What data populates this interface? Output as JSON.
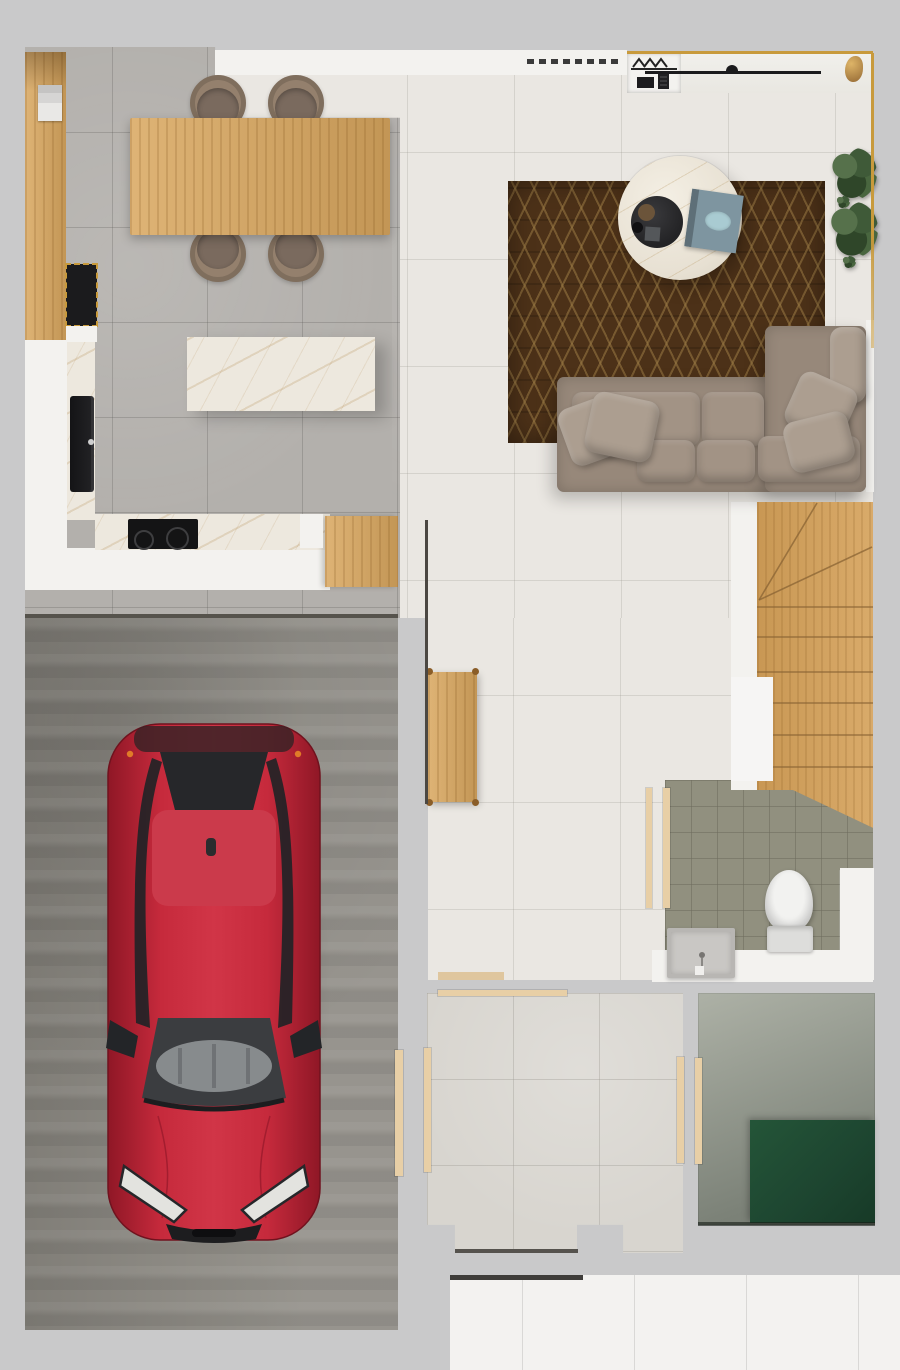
{
  "scene": {
    "type": "architectural-floor-plan-render",
    "view": "top-down",
    "rooms": [
      {
        "name": "kitchen-dining",
        "objects": [
          "wall-cabinet-column",
          "coffee-machine",
          "black-counter",
          "black-sink",
          "marble-counter",
          "cooktop",
          "kitchen-island",
          "dining-table",
          "dining-chairs-x4"
        ]
      },
      {
        "name": "living-room",
        "objects": [
          "geometric-rug",
          "round-marble-coffee-table",
          "decor-tray",
          "book",
          "corner-sofa",
          "throw-pillows",
          "potted-plants-x2",
          "wall-rail",
          "coat-hangers",
          "gold-trim"
        ]
      },
      {
        "name": "staircase",
        "objects": [
          "winder-stairs"
        ]
      },
      {
        "name": "hallway",
        "objects": [
          "wooden-bench",
          "wood-threshold"
        ]
      },
      {
        "name": "bathroom",
        "objects": [
          "toilet",
          "vanity-sink",
          "door"
        ]
      },
      {
        "name": "garage",
        "objects": [
          "red-car",
          "concrete-floor",
          "side-door"
        ]
      },
      {
        "name": "storage-room",
        "objects": [
          "doors-x3"
        ]
      },
      {
        "name": "utility-room",
        "objects": [
          "green-mat",
          "door"
        ]
      },
      {
        "name": "porch",
        "objects": [
          "tile-floor"
        ]
      }
    ]
  },
  "palette": {
    "margin": "#c9c9ca",
    "wall": "#f3f2ef",
    "wallLine": "#4b4742",
    "livingTile": "#eae7e2",
    "kitchenTile": "#b3b0ac",
    "bathTile": "#91907f",
    "storageTile": "#d8d5cf",
    "porchTile": "#f3f2f0",
    "garage": "#8f8c85",
    "concreteA": "#adb1a6",
    "concreteB": "#7b8177",
    "greenBox": "#1d4530",
    "wood": "#d9a75f",
    "woodDeep": "#b9863e",
    "marble": "#ede8de",
    "marbleVein": "#bf9e6d",
    "rug": "#4c3118",
    "rugLine": "#9a7a44",
    "sofa": "#97887a",
    "cushion": "#a29385",
    "pillow": "#ac9e90",
    "chair": "#94806d",
    "chairSeat": "#7a6a5e",
    "stairsWood": "#d5a159",
    "gold": "#c89a3c",
    "black": "#1b1b1d",
    "doorWood": "#e8cfa6",
    "toilet": "#ebebe9",
    "vanity": "#b8b6b3",
    "carRed": "#c02537",
    "carRedDark": "#8f1726",
    "carRoof": "#cb3a4b",
    "glass": "#26272a",
    "glassLight": "#929598",
    "taillightOrange": "#e07b28"
  }
}
